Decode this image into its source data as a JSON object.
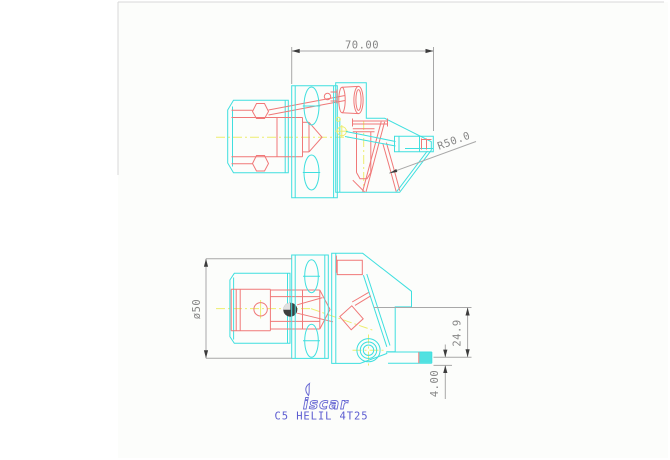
{
  "drawing": {
    "dimensions": {
      "width": "70.00",
      "radius": "R50.0",
      "diameter": "ø50",
      "height": "24.9",
      "nozzle_offset": "4.00"
    },
    "branding": {
      "logo": "iscar",
      "part_number": "C5 HELIL 4T25"
    },
    "colors": {
      "geometry_cyan": "#3FDFDF",
      "detail_red": "#F07878",
      "centerline_yellow": "#EDED6E",
      "dimension_gray": "#A8A8A8",
      "arrow_dark": "#3C3C3C",
      "text_gray": "#868686",
      "brand_blue": "#6A6AD4",
      "part_blue": "#5B5BD0",
      "marker_dark": "#3F3F3F",
      "page_edge": "#D8D8D8",
      "canvas_bg": "#FCFDFB"
    }
  }
}
